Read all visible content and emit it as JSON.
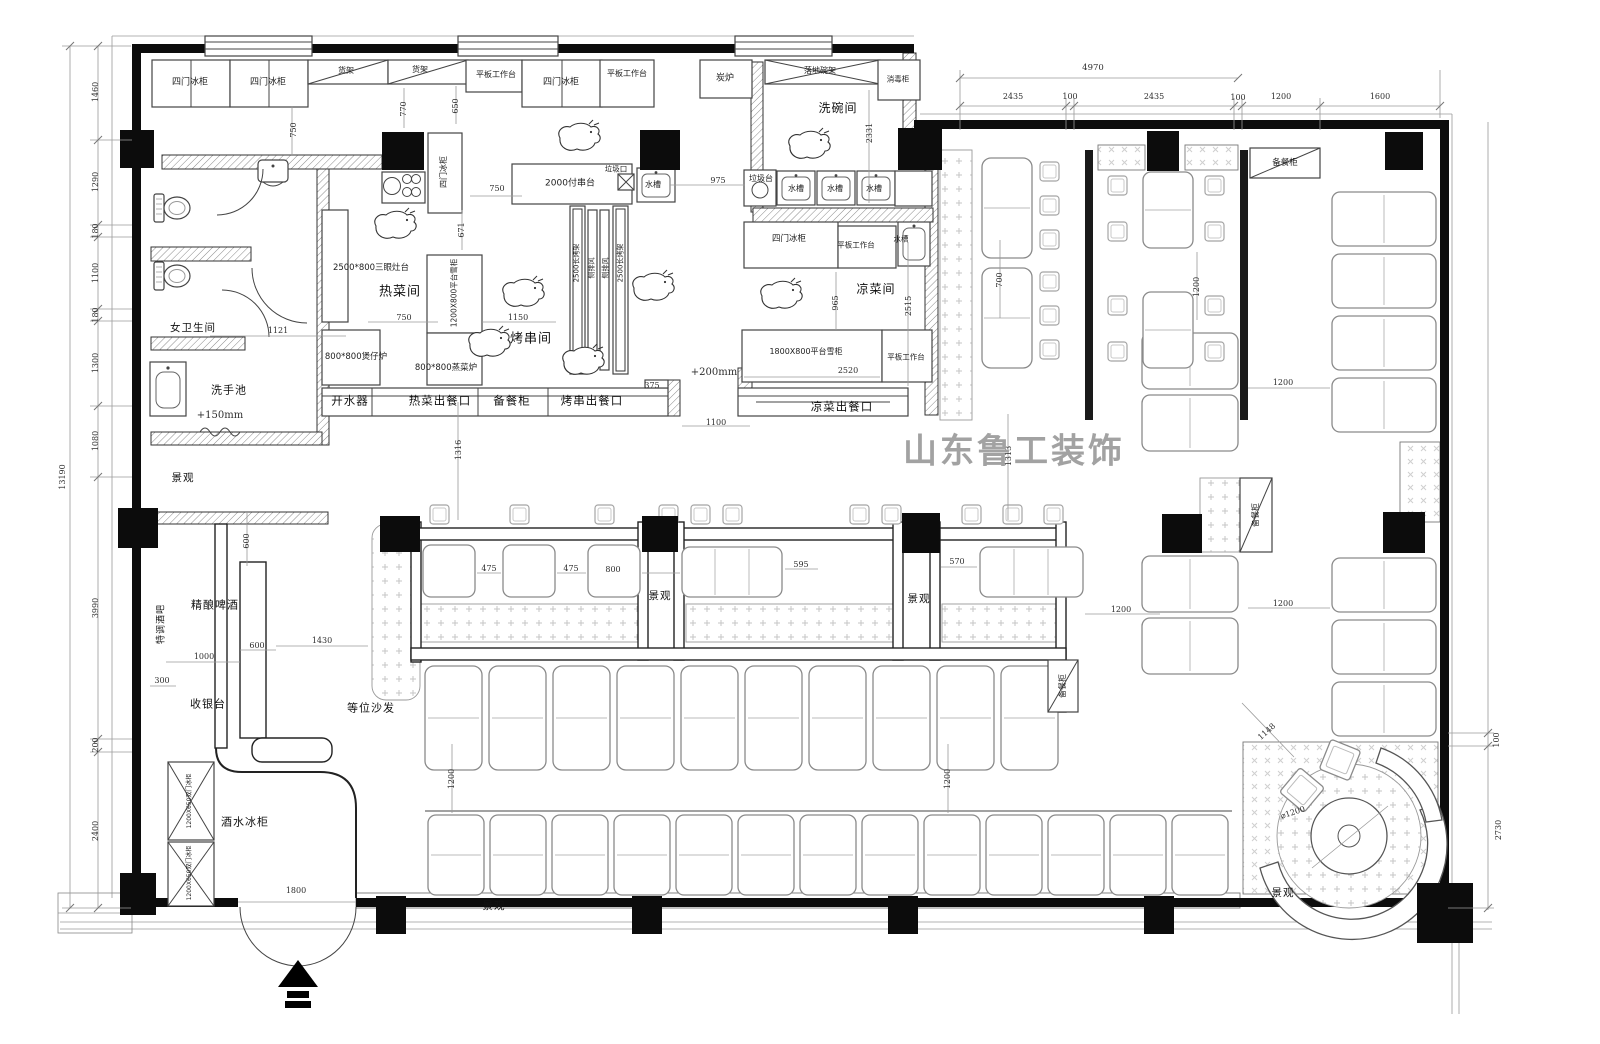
{
  "watermark": {
    "text": "山东鲁工装饰"
  },
  "colors": {
    "wall": "#0c0c0c",
    "hatch": "#888888",
    "dim_text": "#2e2e2e",
    "watermark": "#a2a2a2"
  },
  "labels": [
    {
      "t": "四门冰柜",
      "x": 190,
      "y": 83,
      "s": 9,
      "c": "equip"
    },
    {
      "t": "四门冰柜",
      "x": 268,
      "y": 83,
      "s": 9,
      "c": "equip"
    },
    {
      "t": "货架",
      "x": 346,
      "y": 71,
      "s": 8,
      "c": "equip"
    },
    {
      "t": "货架",
      "x": 420,
      "y": 70,
      "s": 8,
      "c": "equip"
    },
    {
      "t": "平板工作台",
      "x": 496,
      "y": 75,
      "s": 8,
      "c": "equip"
    },
    {
      "t": "四门冰柜",
      "x": 561,
      "y": 83,
      "s": 9,
      "c": "equip"
    },
    {
      "t": "平板工作台",
      "x": 627,
      "y": 74,
      "s": 8,
      "c": "equip"
    },
    {
      "t": "炭炉",
      "x": 725,
      "y": 79,
      "s": 9,
      "c": "equip"
    },
    {
      "t": "落地碗架",
      "x": 820,
      "y": 71,
      "s": 8,
      "c": "equip"
    },
    {
      "t": "消毒柜",
      "x": 898,
      "y": 79,
      "s": 7.5,
      "c": "equip"
    },
    {
      "t": "洗碗间",
      "x": 838,
      "y": 108,
      "s": 12,
      "c": "room"
    },
    {
      "t": "750",
      "x": 294,
      "y": 130,
      "s": 8,
      "c": "dim",
      "v": 1
    },
    {
      "t": "770",
      "x": 404,
      "y": 109,
      "s": 8,
      "c": "dim",
      "v": 1
    },
    {
      "t": "650",
      "x": 456,
      "y": 106,
      "s": 8,
      "c": "dim",
      "v": 1
    },
    {
      "t": "750",
      "x": 497,
      "y": 189,
      "s": 8,
      "c": "dim"
    },
    {
      "t": "671",
      "x": 462,
      "y": 230,
      "s": 8,
      "c": "dim",
      "v": 1
    },
    {
      "t": "975",
      "x": 718,
      "y": 181,
      "s": 8,
      "c": "dim"
    },
    {
      "t": "2331",
      "x": 870,
      "y": 133,
      "s": 8,
      "c": "dim",
      "v": 1
    },
    {
      "t": "四门冰柜",
      "x": 444,
      "y": 172,
      "s": 8,
      "c": "equip",
      "v": 1
    },
    {
      "t": "2000付串台",
      "x": 570,
      "y": 184,
      "s": 9,
      "c": "equip"
    },
    {
      "t": "垃圾口",
      "x": 616,
      "y": 169,
      "s": 7.5,
      "c": "equip"
    },
    {
      "t": "水槽",
      "x": 653,
      "y": 185,
      "s": 8,
      "c": "equip"
    },
    {
      "t": "垃圾台",
      "x": 761,
      "y": 179,
      "s": 8,
      "c": "equip"
    },
    {
      "t": "水槽",
      "x": 796,
      "y": 189,
      "s": 8,
      "c": "equip"
    },
    {
      "t": "水槽",
      "x": 835,
      "y": 189,
      "s": 8,
      "c": "equip"
    },
    {
      "t": "水槽",
      "x": 874,
      "y": 189,
      "s": 8,
      "c": "equip"
    },
    {
      "t": "四门冰柜",
      "x": 789,
      "y": 239,
      "s": 8.5,
      "c": "equip"
    },
    {
      "t": "平板工作台",
      "x": 856,
      "y": 245,
      "s": 7.5,
      "c": "equip"
    },
    {
      "t": "水槽",
      "x": 901,
      "y": 239,
      "s": 7.5,
      "c": "equip"
    },
    {
      "t": "凉菜间",
      "x": 876,
      "y": 289,
      "s": 12,
      "c": "room"
    },
    {
      "t": "965",
      "x": 836,
      "y": 303,
      "s": 8,
      "c": "dim",
      "v": 1
    },
    {
      "t": "2515",
      "x": 909,
      "y": 306,
      "s": 8,
      "c": "dim",
      "v": 1
    },
    {
      "t": "1800X800平台雪柜",
      "x": 806,
      "y": 352,
      "s": 8,
      "c": "equip"
    },
    {
      "t": "2520",
      "x": 848,
      "y": 371,
      "s": 8,
      "c": "dim"
    },
    {
      "t": "平板工作台",
      "x": 906,
      "y": 357,
      "s": 7.5,
      "c": "equip"
    },
    {
      "t": "凉菜出餐口",
      "x": 842,
      "y": 407,
      "s": 11.5,
      "c": "room"
    },
    {
      "t": "2500*800三眼灶台",
      "x": 371,
      "y": 268,
      "s": 8.5,
      "c": "equip"
    },
    {
      "t": "热菜间",
      "x": 400,
      "y": 292,
      "s": 13,
      "c": "room"
    },
    {
      "t": "750",
      "x": 404,
      "y": 318,
      "s": 8,
      "c": "dim"
    },
    {
      "t": "1200X800平台雪柜",
      "x": 454,
      "y": 293,
      "s": 7.5,
      "c": "equip",
      "v": 1
    },
    {
      "t": "1150",
      "x": 518,
      "y": 318,
      "s": 8,
      "c": "dim"
    },
    {
      "t": "800*800煲仔炉",
      "x": 356,
      "y": 357,
      "s": 8.5,
      "c": "equip"
    },
    {
      "t": "800*800蒸菜炉",
      "x": 446,
      "y": 368,
      "s": 8.5,
      "c": "equip"
    },
    {
      "t": "烤串间",
      "x": 531,
      "y": 339,
      "s": 13,
      "c": "room"
    },
    {
      "t": "2500长烤架",
      "x": 577,
      "y": 263,
      "s": 7,
      "c": "equip",
      "v": 1
    },
    {
      "t": "侧排风",
      "x": 592,
      "y": 268,
      "s": 7,
      "c": "equip",
      "v": 1
    },
    {
      "t": "侧排风",
      "x": 606,
      "y": 268,
      "s": 7,
      "c": "equip",
      "v": 1
    },
    {
      "t": "2500长烤架",
      "x": 621,
      "y": 263,
      "s": 7,
      "c": "equip",
      "v": 1
    },
    {
      "t": "开水器",
      "x": 350,
      "y": 401,
      "s": 11.5,
      "c": "room"
    },
    {
      "t": "热菜出餐口",
      "x": 440,
      "y": 401,
      "s": 11.5,
      "c": "room"
    },
    {
      "t": "备餐柜",
      "x": 512,
      "y": 401,
      "s": 11.5,
      "c": "room"
    },
    {
      "t": "烤串出餐口",
      "x": 592,
      "y": 401,
      "s": 11.5,
      "c": "room"
    },
    {
      "t": "375",
      "x": 652,
      "y": 386,
      "s": 8,
      "c": "dim"
    },
    {
      "t": "+200mm",
      "x": 714,
      "y": 373,
      "s": 10,
      "c": "dim"
    },
    {
      "t": "1100",
      "x": 716,
      "y": 423,
      "s": 8,
      "c": "dim"
    },
    {
      "t": "1316",
      "x": 459,
      "y": 450,
      "s": 8,
      "c": "dim",
      "v": 1
    },
    {
      "t": "1313",
      "x": 1009,
      "y": 456,
      "s": 8,
      "c": "dim",
      "v": 1
    },
    {
      "t": "女卫生间",
      "x": 193,
      "y": 328,
      "s": 10.5,
      "c": "room"
    },
    {
      "t": "1121",
      "x": 278,
      "y": 331,
      "s": 8,
      "c": "dim"
    },
    {
      "t": "洗手池",
      "x": 229,
      "y": 390,
      "s": 11,
      "c": "room"
    },
    {
      "t": "+150mm",
      "x": 220,
      "y": 416,
      "s": 10,
      "c": "dim"
    },
    {
      "t": "景观",
      "x": 183,
      "y": 478,
      "s": 10.5,
      "c": "room"
    },
    {
      "t": "600",
      "x": 247,
      "y": 541,
      "s": 8,
      "c": "dim",
      "v": 1
    },
    {
      "t": "精酿啤酒",
      "x": 215,
      "y": 605,
      "s": 11,
      "c": "room"
    },
    {
      "t": "特调酒吧",
      "x": 162,
      "y": 624,
      "s": 9,
      "c": "room",
      "v": 1
    },
    {
      "t": "1000",
      "x": 204,
      "y": 657,
      "s": 8,
      "c": "dim"
    },
    {
      "t": "600",
      "x": 257,
      "y": 646,
      "s": 8,
      "c": "dim"
    },
    {
      "t": "1430",
      "x": 322,
      "y": 641,
      "s": 8,
      "c": "dim"
    },
    {
      "t": "300",
      "x": 162,
      "y": 681,
      "s": 8,
      "c": "dim"
    },
    {
      "t": "收银台",
      "x": 208,
      "y": 704,
      "s": 11,
      "c": "room"
    },
    {
      "t": "酒水冰柜",
      "x": 245,
      "y": 822,
      "s": 11,
      "c": "room"
    },
    {
      "t": "1200X650双门冰柜",
      "x": 190,
      "y": 801,
      "s": 6,
      "c": "equip",
      "v": 1
    },
    {
      "t": "1200X650双门冰柜",
      "x": 190,
      "y": 873,
      "s": 6,
      "c": "equip",
      "v": 1
    },
    {
      "t": "1800",
      "x": 296,
      "y": 891,
      "s": 8,
      "c": "dim"
    },
    {
      "t": "等位沙发",
      "x": 371,
      "y": 708,
      "s": 11,
      "c": "room"
    },
    {
      "t": "475",
      "x": 489,
      "y": 569,
      "s": 8,
      "c": "dim"
    },
    {
      "t": "475",
      "x": 571,
      "y": 569,
      "s": 8,
      "c": "dim"
    },
    {
      "t": "800",
      "x": 613,
      "y": 570,
      "s": 8,
      "c": "dim"
    },
    {
      "t": "景观",
      "x": 660,
      "y": 596,
      "s": 10.5,
      "c": "room"
    },
    {
      "t": "595",
      "x": 801,
      "y": 565,
      "s": 8,
      "c": "dim"
    },
    {
      "t": "570",
      "x": 957,
      "y": 562,
      "s": 8,
      "c": "dim"
    },
    {
      "t": "景观",
      "x": 919,
      "y": 599,
      "s": 10.5,
      "c": "room"
    },
    {
      "t": "1200",
      "x": 1121,
      "y": 610,
      "s": 8,
      "c": "dim"
    },
    {
      "t": "备餐柜",
      "x": 1063,
      "y": 686,
      "s": 8,
      "c": "equip",
      "v": 1
    },
    {
      "t": "备餐柜",
      "x": 1256,
      "y": 515,
      "s": 8,
      "c": "equip",
      "v": 1
    },
    {
      "t": "1200",
      "x": 1283,
      "y": 383,
      "s": 8,
      "c": "dim"
    },
    {
      "t": "1200",
      "x": 1283,
      "y": 604,
      "s": 8,
      "c": "dim"
    },
    {
      "t": "备餐柜",
      "x": 1285,
      "y": 163,
      "s": 8.5,
      "c": "equip"
    },
    {
      "t": "4970",
      "x": 1093,
      "y": 68,
      "s": 8.5,
      "c": "dim"
    },
    {
      "t": "2435",
      "x": 1013,
      "y": 97,
      "s": 8,
      "c": "dim"
    },
    {
      "t": "100",
      "x": 1070,
      "y": 97,
      "s": 8,
      "c": "dim"
    },
    {
      "t": "2435",
      "x": 1154,
      "y": 97,
      "s": 8,
      "c": "dim"
    },
    {
      "t": "100",
      "x": 1238,
      "y": 98,
      "s": 8,
      "c": "dim"
    },
    {
      "t": "1200",
      "x": 1281,
      "y": 97,
      "s": 8,
      "c": "dim"
    },
    {
      "t": "1600",
      "x": 1380,
      "y": 97,
      "s": 8,
      "c": "dim"
    },
    {
      "t": "700",
      "x": 1000,
      "y": 280,
      "s": 8,
      "c": "dim",
      "v": 1
    },
    {
      "t": "1200",
      "x": 1197,
      "y": 287,
      "s": 8,
      "c": "dim",
      "v": 1
    },
    {
      "t": "1200",
      "x": 452,
      "y": 779,
      "s": 8,
      "c": "dim",
      "v": 1
    },
    {
      "t": "1200",
      "x": 948,
      "y": 779,
      "s": 8,
      "c": "dim",
      "v": 1
    },
    {
      "t": "景观",
      "x": 494,
      "y": 906,
      "s": 10.5,
      "c": "room"
    },
    {
      "t": "景观",
      "x": 1283,
      "y": 893,
      "s": 10.5,
      "c": "room"
    },
    {
      "t": "1148",
      "x": 1267,
      "y": 732,
      "s": 8,
      "c": "dim",
      "r": -42
    },
    {
      "t": "⌀1200",
      "x": 1293,
      "y": 813,
      "s": 8,
      "c": "dim",
      "r": -18
    },
    {
      "t": "100",
      "x": 1497,
      "y": 740,
      "s": 8,
      "c": "dim",
      "v": 1
    },
    {
      "t": "2730",
      "x": 1499,
      "y": 830,
      "s": 8,
      "c": "dim",
      "v": 1
    },
    {
      "t": "13190",
      "x": 63,
      "y": 477,
      "s": 8,
      "c": "dim",
      "v": 1
    },
    {
      "t": "1460",
      "x": 96,
      "y": 92,
      "s": 8,
      "c": "dim",
      "v": 1
    },
    {
      "t": "1290",
      "x": 96,
      "y": 182,
      "s": 8,
      "c": "dim",
      "v": 1
    },
    {
      "t": "180",
      "x": 96,
      "y": 231,
      "s": 8,
      "c": "dim",
      "v": 1
    },
    {
      "t": "1100",
      "x": 96,
      "y": 273,
      "s": 8,
      "c": "dim",
      "v": 1
    },
    {
      "t": "180",
      "x": 96,
      "y": 315,
      "s": 8,
      "c": "dim",
      "v": 1
    },
    {
      "t": "1300",
      "x": 96,
      "y": 363,
      "s": 8,
      "c": "dim",
      "v": 1
    },
    {
      "t": "1080",
      "x": 96,
      "y": 441,
      "s": 8,
      "c": "dim",
      "v": 1
    },
    {
      "t": "3990",
      "x": 96,
      "y": 608,
      "s": 8,
      "c": "dim",
      "v": 1
    },
    {
      "t": "200",
      "x": 96,
      "y": 745,
      "s": 8,
      "c": "dim",
      "v": 1
    },
    {
      "t": "2400",
      "x": 96,
      "y": 831,
      "s": 8,
      "c": "dim",
      "v": 1
    }
  ]
}
